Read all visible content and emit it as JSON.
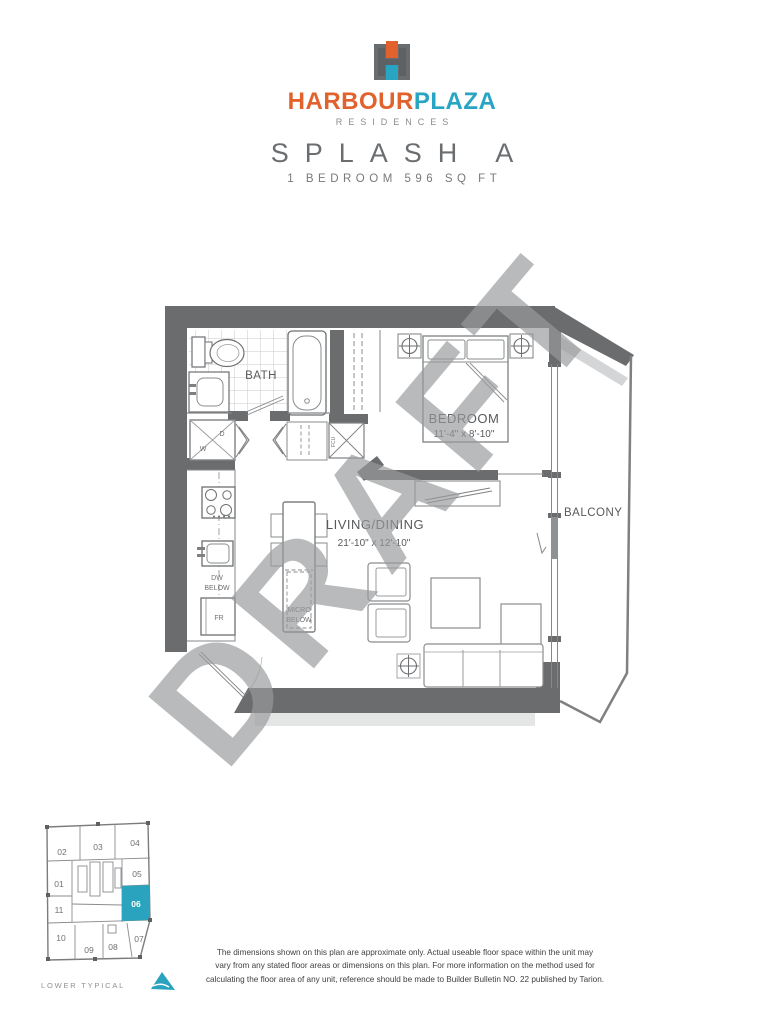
{
  "brand": {
    "word1": "HARBOUR",
    "word2": "PLAZA",
    "tagline": "RESIDENCES"
  },
  "plan": {
    "name": "SPLASH A",
    "spec": "1 BEDROOM 596 SQ FT"
  },
  "floorplan": {
    "labels": {
      "bath": "BATH",
      "bedroom": "BEDROOM",
      "bedroom_dim": "11'-4\" x 8'-10\"",
      "living": "LIVING/DINING",
      "living_dim": "21'-10\" x 12'-10\"",
      "balcony": "BALCONY",
      "dw1": "DW",
      "dw2": "BELOW",
      "fr": "FR",
      "micro1": "MICRO",
      "micro2": "BELOW",
      "dryer": "D",
      "washer": "W",
      "fcu": "FCU"
    }
  },
  "watermark": {
    "text": "DRAFT"
  },
  "keyplan": {
    "caption": "LOWER TYPICAL",
    "highlighted_unit": "06",
    "units": [
      "01",
      "02",
      "03",
      "04",
      "05",
      "06",
      "07",
      "08",
      "09",
      "10",
      "11"
    ]
  },
  "disclaimer": {
    "line1": "The dimensions shown on this plan are approximate only. Actual useable floor space within the unit may",
    "line2": "vary from any stated floor areas or dimensions on this plan. For more information on the method used for",
    "line3": "calculating the floor area of any unit, reference should be made to Builder Bulletin NO. 22 published by Tarion."
  },
  "colors": {
    "accent_orange": "#e2622e",
    "accent_teal": "#27a5c3",
    "wall_gray": "#6a6c6e",
    "watermark_gray": "#98999b",
    "keyplan_highlight": "#2aa4be"
  }
}
